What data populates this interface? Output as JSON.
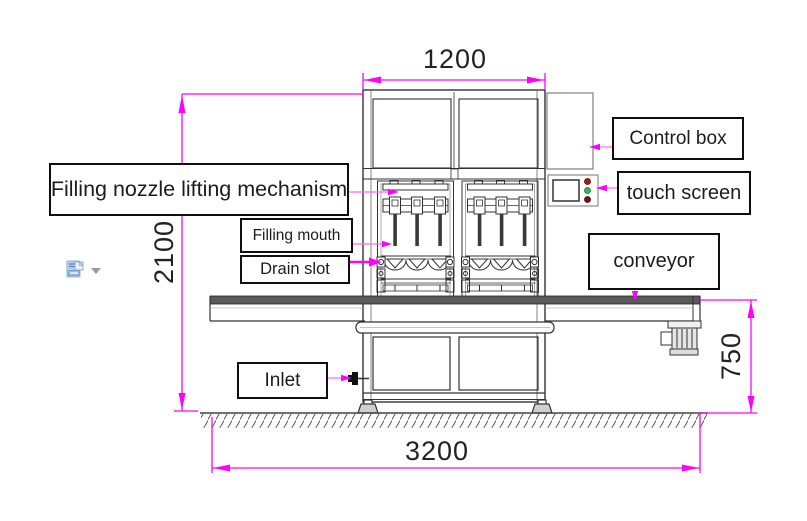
{
  "drawing": {
    "title": "filling machine front-view technical drawing",
    "labels": {
      "lifting_mechanism": "Filling nozzle lifting mechanism",
      "filling_mouth": "Filling mouth",
      "drain_slot": "Drain slot",
      "control_box": "Control box",
      "touch_screen": "touch screen",
      "conveyor": "conveyor",
      "inlet": "Inlet"
    },
    "dimensions": {
      "machine_width": "1200",
      "machine_height": "2100",
      "conveyor_height": "750",
      "total_length": "3200"
    },
    "colors": {
      "dimension_lines": "#ff00ff",
      "machine_lines": "#333333",
      "label_border": "#0f0f0f",
      "conveyor_band": "#5a5a5a",
      "button_top": "#b51414",
      "button_middle": "#3db45a",
      "button_bottom": "#7d0f0f",
      "paste_icon_blue": "#b9cdea"
    },
    "icons": {
      "paste_options": "document-paste-icon",
      "paste_dropdown": "chevron-down-icon"
    }
  }
}
